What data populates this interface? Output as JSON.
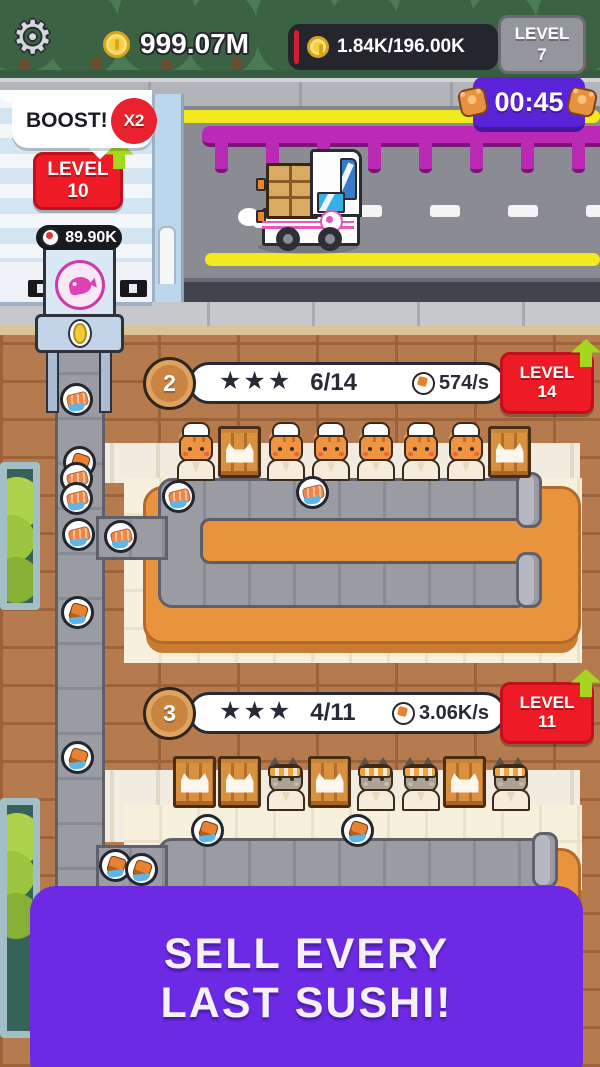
{
  "hud": {
    "coins": "999.07M",
    "sushi_meter": "1.84K/196.00K",
    "level": {
      "label": "LEVEL",
      "value": "7"
    },
    "timer": "00:45"
  },
  "factory": {
    "boost_label": "BOOST!",
    "boost_multiplier": "X2",
    "level": {
      "label": "LEVEL",
      "value": "10"
    },
    "storage": "89.90K"
  },
  "stations": [
    {
      "number": "2",
      "stars": "★★★",
      "progress": "6/14",
      "rate": "574/s",
      "level": {
        "label": "LEVEL",
        "value": "14"
      },
      "cat_variant": "orange",
      "slots": [
        "cat",
        "crate",
        "cat",
        "cat",
        "cat",
        "cat",
        "cat",
        "crate"
      ]
    },
    {
      "number": "3",
      "stars": "★★★",
      "progress": "4/11",
      "rate": "3.06K/s",
      "level": {
        "label": "LEVEL",
        "value": "11"
      },
      "cat_variant": "gray",
      "slots": [
        "crate",
        "crate",
        "cat",
        "crate",
        "cat",
        "cat",
        "crate",
        "cat"
      ]
    }
  ],
  "banner": {
    "line1": "SELL EVERY",
    "line2": "LAST SUSHI!"
  },
  "sprites": {
    "plates": [
      {
        "x": 60,
        "y": 383,
        "t": "nigiri"
      },
      {
        "x": 63,
        "y": 446,
        "t": "roll"
      },
      {
        "x": 60,
        "y": 462,
        "t": "nigiri"
      },
      {
        "x": 60,
        "y": 482,
        "t": "nigiri"
      },
      {
        "x": 62,
        "y": 518,
        "t": "nigiri"
      },
      {
        "x": 61,
        "y": 596,
        "t": "roll"
      },
      {
        "x": 61,
        "y": 741,
        "t": "roll"
      },
      {
        "x": 104,
        "y": 520,
        "t": "nigiri"
      },
      {
        "x": 162,
        "y": 480,
        "t": "nigiri"
      },
      {
        "x": 296,
        "y": 476,
        "t": "nigiri"
      },
      {
        "x": 99,
        "y": 849,
        "t": "roll"
      },
      {
        "x": 125,
        "y": 853,
        "t": "roll"
      },
      {
        "x": 191,
        "y": 814,
        "t": "roll"
      },
      {
        "x": 341,
        "y": 814,
        "t": "roll"
      }
    ]
  },
  "colors": {
    "banner_purple": "#6c2ae4",
    "timer_purple": "#5a23d8",
    "badge_red": "#ee1b26",
    "coin_yellow": "#f6ce3e",
    "table_orange": "#e8943f",
    "belt_gray": "#9b9ba4",
    "brick_brown": "#b57b4e",
    "fence_magenta": "#bb2ab4",
    "arrow_green": "#a6d71f"
  }
}
